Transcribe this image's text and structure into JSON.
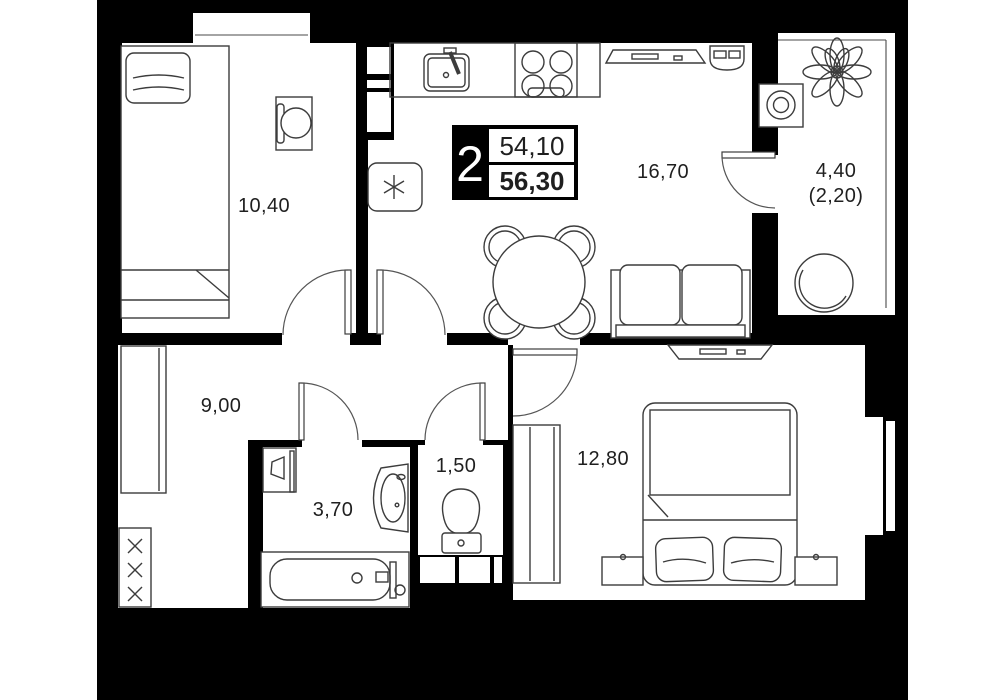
{
  "plan": {
    "title": "2-room apartment floor plan",
    "type_badge": {
      "rooms": "2",
      "area_living": "54,10",
      "area_total": "56,30"
    },
    "rooms": [
      {
        "id": "bedroom-top",
        "area": "10,40"
      },
      {
        "id": "kitchen-living",
        "area": "16,70"
      },
      {
        "id": "balcony",
        "area": "4,40",
        "area_reduced": "(2,20)"
      },
      {
        "id": "hallway",
        "area": "9,00"
      },
      {
        "id": "bathroom",
        "area": "3,70"
      },
      {
        "id": "toilet",
        "area": "1,50"
      },
      {
        "id": "bedroom-main",
        "area": "12,80"
      }
    ],
    "colors": {
      "background": "#000000",
      "floor": "#ffffff",
      "line": "#3c3c3c"
    }
  }
}
